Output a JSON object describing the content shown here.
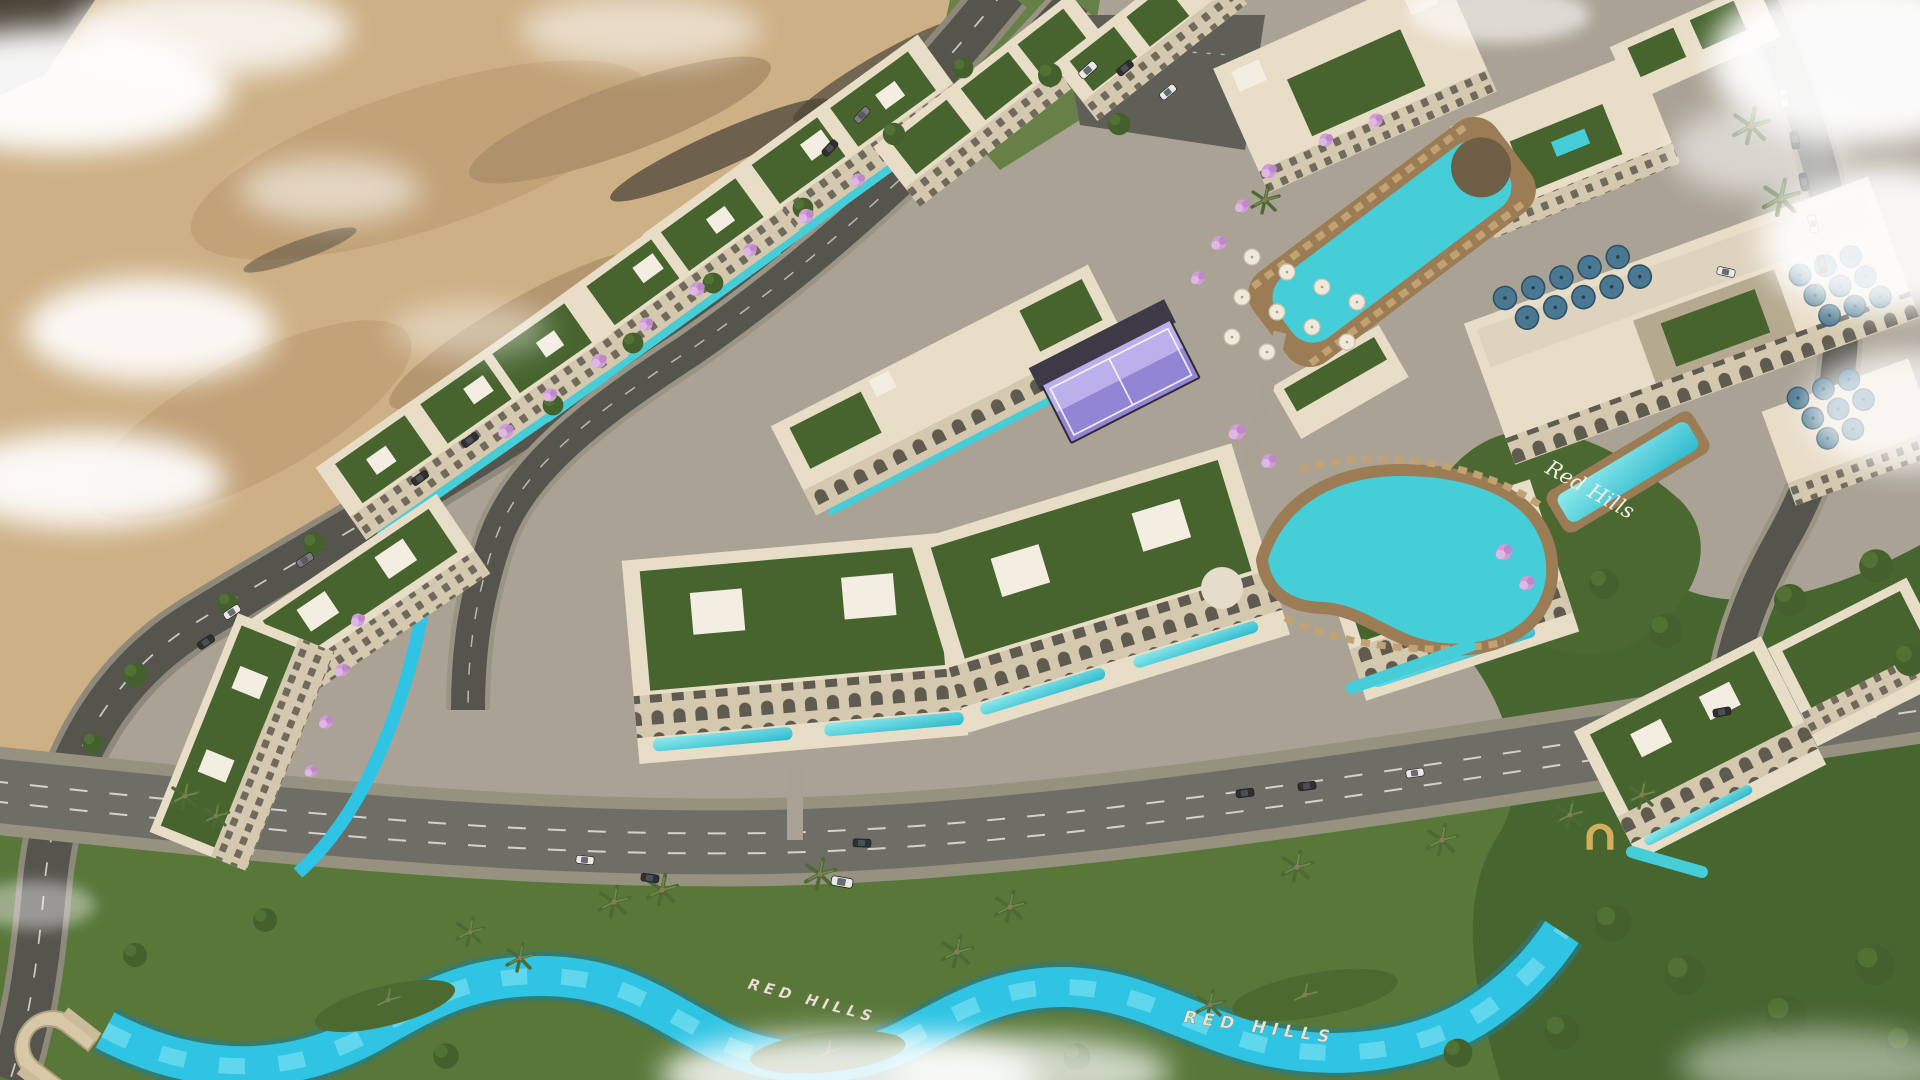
{
  "labels": {
    "hillside_script": "Red Hills",
    "ground_sign_west": "RED HILLS",
    "ground_sign_east": "RED HILLS"
  },
  "colors": {
    "sand": "#cdb085",
    "sand_dark": "#a98d63",
    "rock": "#5d5242",
    "cloud": "#ffffff",
    "asphalt": "#55544d",
    "boulevard": "#6f6e66",
    "sidewalk": "#97917f",
    "lane_marking": "#e6e3da",
    "plaza": "#aaa395",
    "grass": "#587739",
    "grass_dark": "#3f5c2a",
    "hedge": "#36512a",
    "building": "#e8ddc7",
    "building_shade": "#b5a98f",
    "parapet": "#f4efe3",
    "roof_garden": "#47632e",
    "pool": "#45cdd8",
    "pool_light": "#8febed",
    "pool_deck": "#9b7c55",
    "lazy_river": "#2fc4e4",
    "padel_court": "#9083d8",
    "padel_glass": "#c6bcf0",
    "umbrella_blue": "#4a7892",
    "umbrella_white": "#efe9dc",
    "flower_pink": "#d3a3da",
    "palm_green": "#4e6a34",
    "car_white": "#e9e9e7",
    "car_dark": "#2f2f31",
    "sign_text": "#f2eee2"
  }
}
